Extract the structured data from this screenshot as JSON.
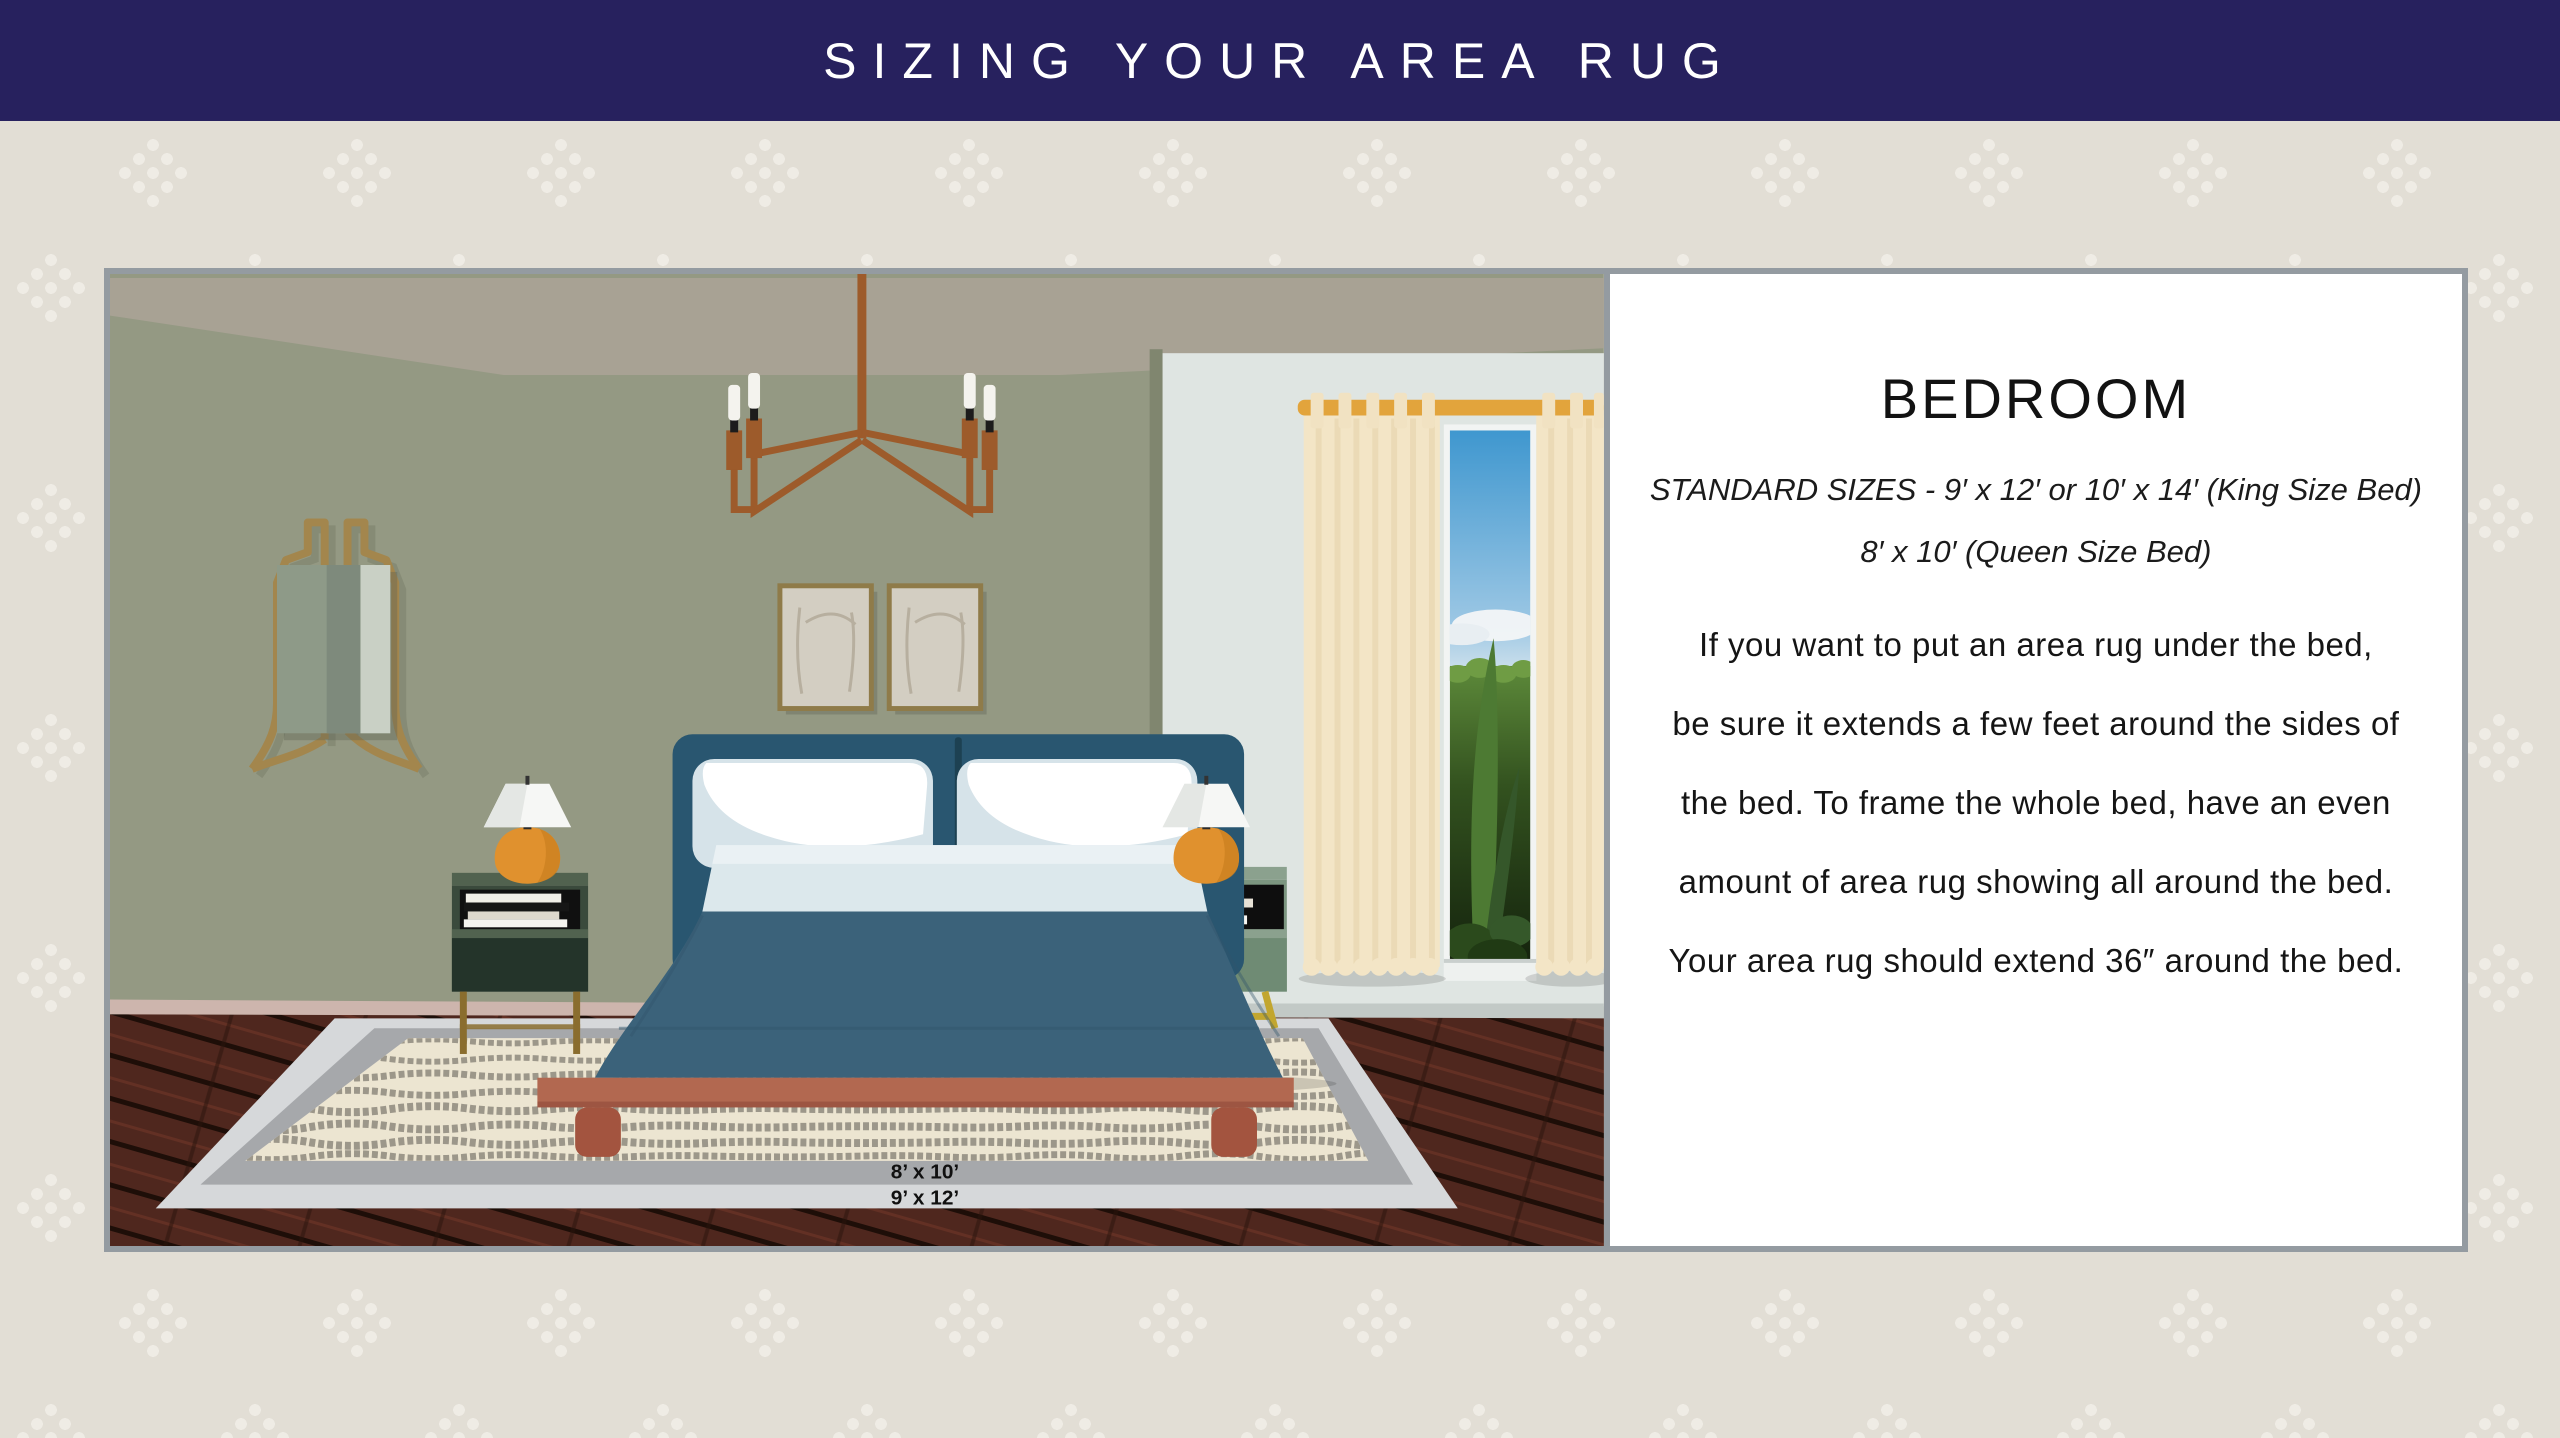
{
  "banner": {
    "title": "SIZING YOUR AREA RUG",
    "bg_color": "#27215e",
    "text_color": "#ffffff"
  },
  "info_panel": {
    "heading": "BEDROOM",
    "sizes_line1": "STANDARD SIZES - 9′ x 12′ or 10′ x 14′ (King Size Bed)",
    "sizes_line2": "8′ x 10′ (Queen Size Bed)",
    "body_lines": [
      "If you want to put an area rug under the bed,",
      "be sure it extends a few feet around the sides of",
      "the bed. To frame the whole bed, have an even",
      "amount of area rug showing all around the bed.",
      "Your area rug should extend 36″ around the bed."
    ]
  },
  "illustration": {
    "scene": "bedroom with king bed on layered area rug",
    "rug_labels": {
      "inner": "8’ x 10’",
      "outer": "9’ x 12’"
    },
    "colors": {
      "page_bg": "#e2ded5",
      "pattern_dot": "#efece5",
      "frame_border": "#949ba1",
      "wall": "#949983",
      "ceiling": "#a8a294",
      "alcove_wall": "#dfe5e2",
      "baseboard_pink": "#cdb5ad",
      "baseboard_gray": "#c2c9c6",
      "floor_wood": "#4f271e",
      "rug_outer_band": "#d6d8da",
      "rug_inner_band": "#a6a8ab",
      "rug_cream": "#ece5d1",
      "rug_stripe": "#948e82",
      "headboard": "#295670",
      "duvet": "#3b627a",
      "sheet": "#dce8ec",
      "bed_frame": "#b26850",
      "nightstand_left": "#3a4a3c",
      "nightstand_right": "#7c9680",
      "lamp_base": "#e0912e",
      "lamp_shade": "#f6f7f5",
      "curtain": "#f3e5c6",
      "curtain_rod": "#e2a43c",
      "brass": "#a3864d",
      "chandelier": "#9d5b2b",
      "window_sky": "#3f97cf",
      "window_hedge": "#33521f"
    }
  }
}
